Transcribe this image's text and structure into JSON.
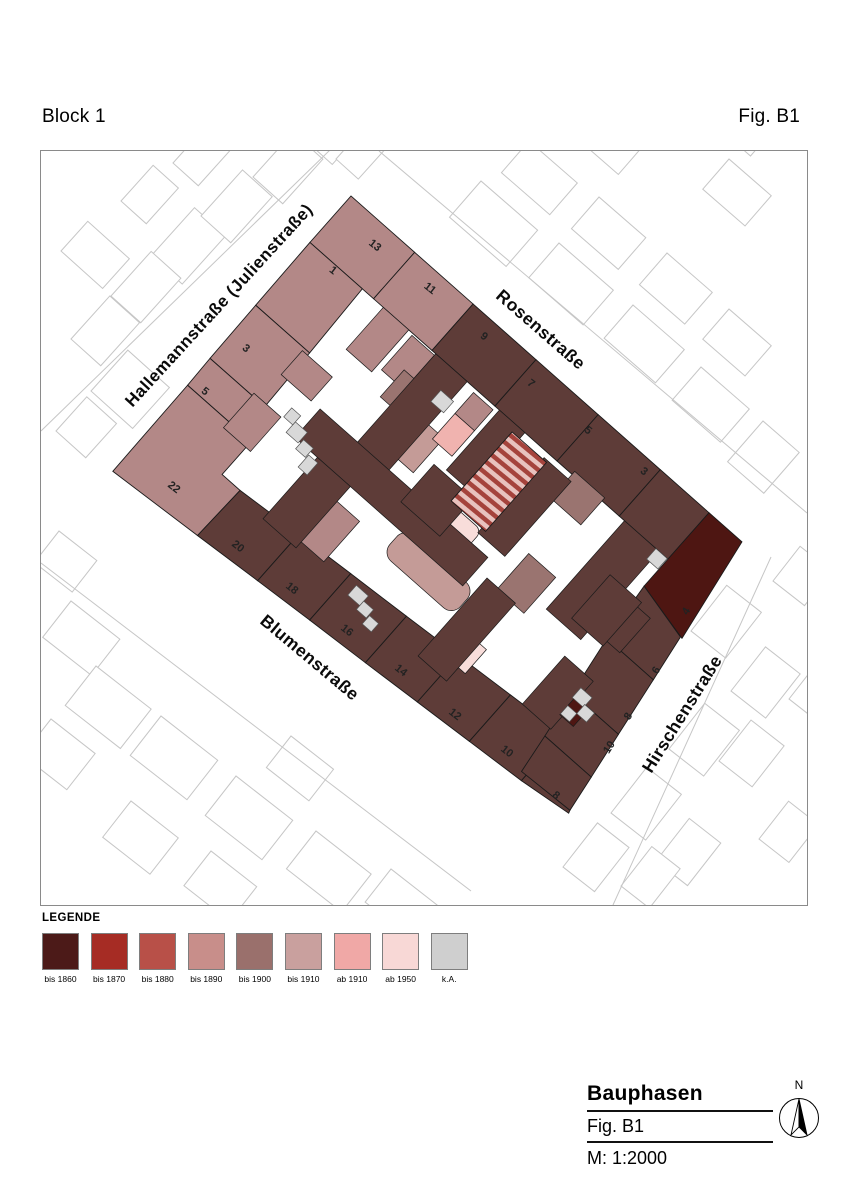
{
  "page": {
    "title_left": "Block 1",
    "title_right": "Fig. B1"
  },
  "map": {
    "streets": [
      {
        "name": "Hallemannstraße (Julienstraße)"
      },
      {
        "name": "Rosenstraße"
      },
      {
        "name": "Blumenstraße"
      },
      {
        "name": "Hirschenstraße"
      }
    ],
    "house_numbers": [
      "1",
      "3",
      "5",
      "22",
      "13",
      "11",
      "9",
      "7",
      "5",
      "3",
      "4",
      "6",
      "8",
      "10",
      "10",
      "8",
      "12",
      "14",
      "16",
      "18",
      "20"
    ],
    "colors": {
      "dark": "#5E3C38",
      "rosy": "#B38887",
      "maroon": "#4E1612",
      "mauve": "#9A7470",
      "dusty": "#C49B97",
      "light": "#F0B3AF",
      "pale": "#F8DDDA",
      "gray": "#D8D8D8",
      "hatch_bg": "#E8C2BE",
      "hatch_stripe": "#A5433C",
      "outline": "#1a1a1a",
      "bg_stroke": "#c6c6c6",
      "label": "#222222"
    }
  },
  "legend": {
    "heading": "LEGENDE",
    "items": [
      {
        "label": "bis 1860",
        "color": "#4C1A18"
      },
      {
        "label": "bis 1870",
        "color": "#A62C24"
      },
      {
        "label": "bis 1880",
        "color": "#B85048"
      },
      {
        "label": "bis 1890",
        "color": "#C88E8A"
      },
      {
        "label": "bis 1900",
        "color": "#9A706C"
      },
      {
        "label": "bis 1910",
        "color": "#C9A09E"
      },
      {
        "label": "ab 1910",
        "color": "#F0A8A6"
      },
      {
        "label": "ab 1950",
        "color": "#F8D8D6"
      },
      {
        "label": "k.A.",
        "color": "#CFCFCF"
      }
    ]
  },
  "title_block": {
    "title": "Bauphasen",
    "figure": "Fig. B1",
    "scale": "M: 1:2000",
    "north_label": "N"
  }
}
